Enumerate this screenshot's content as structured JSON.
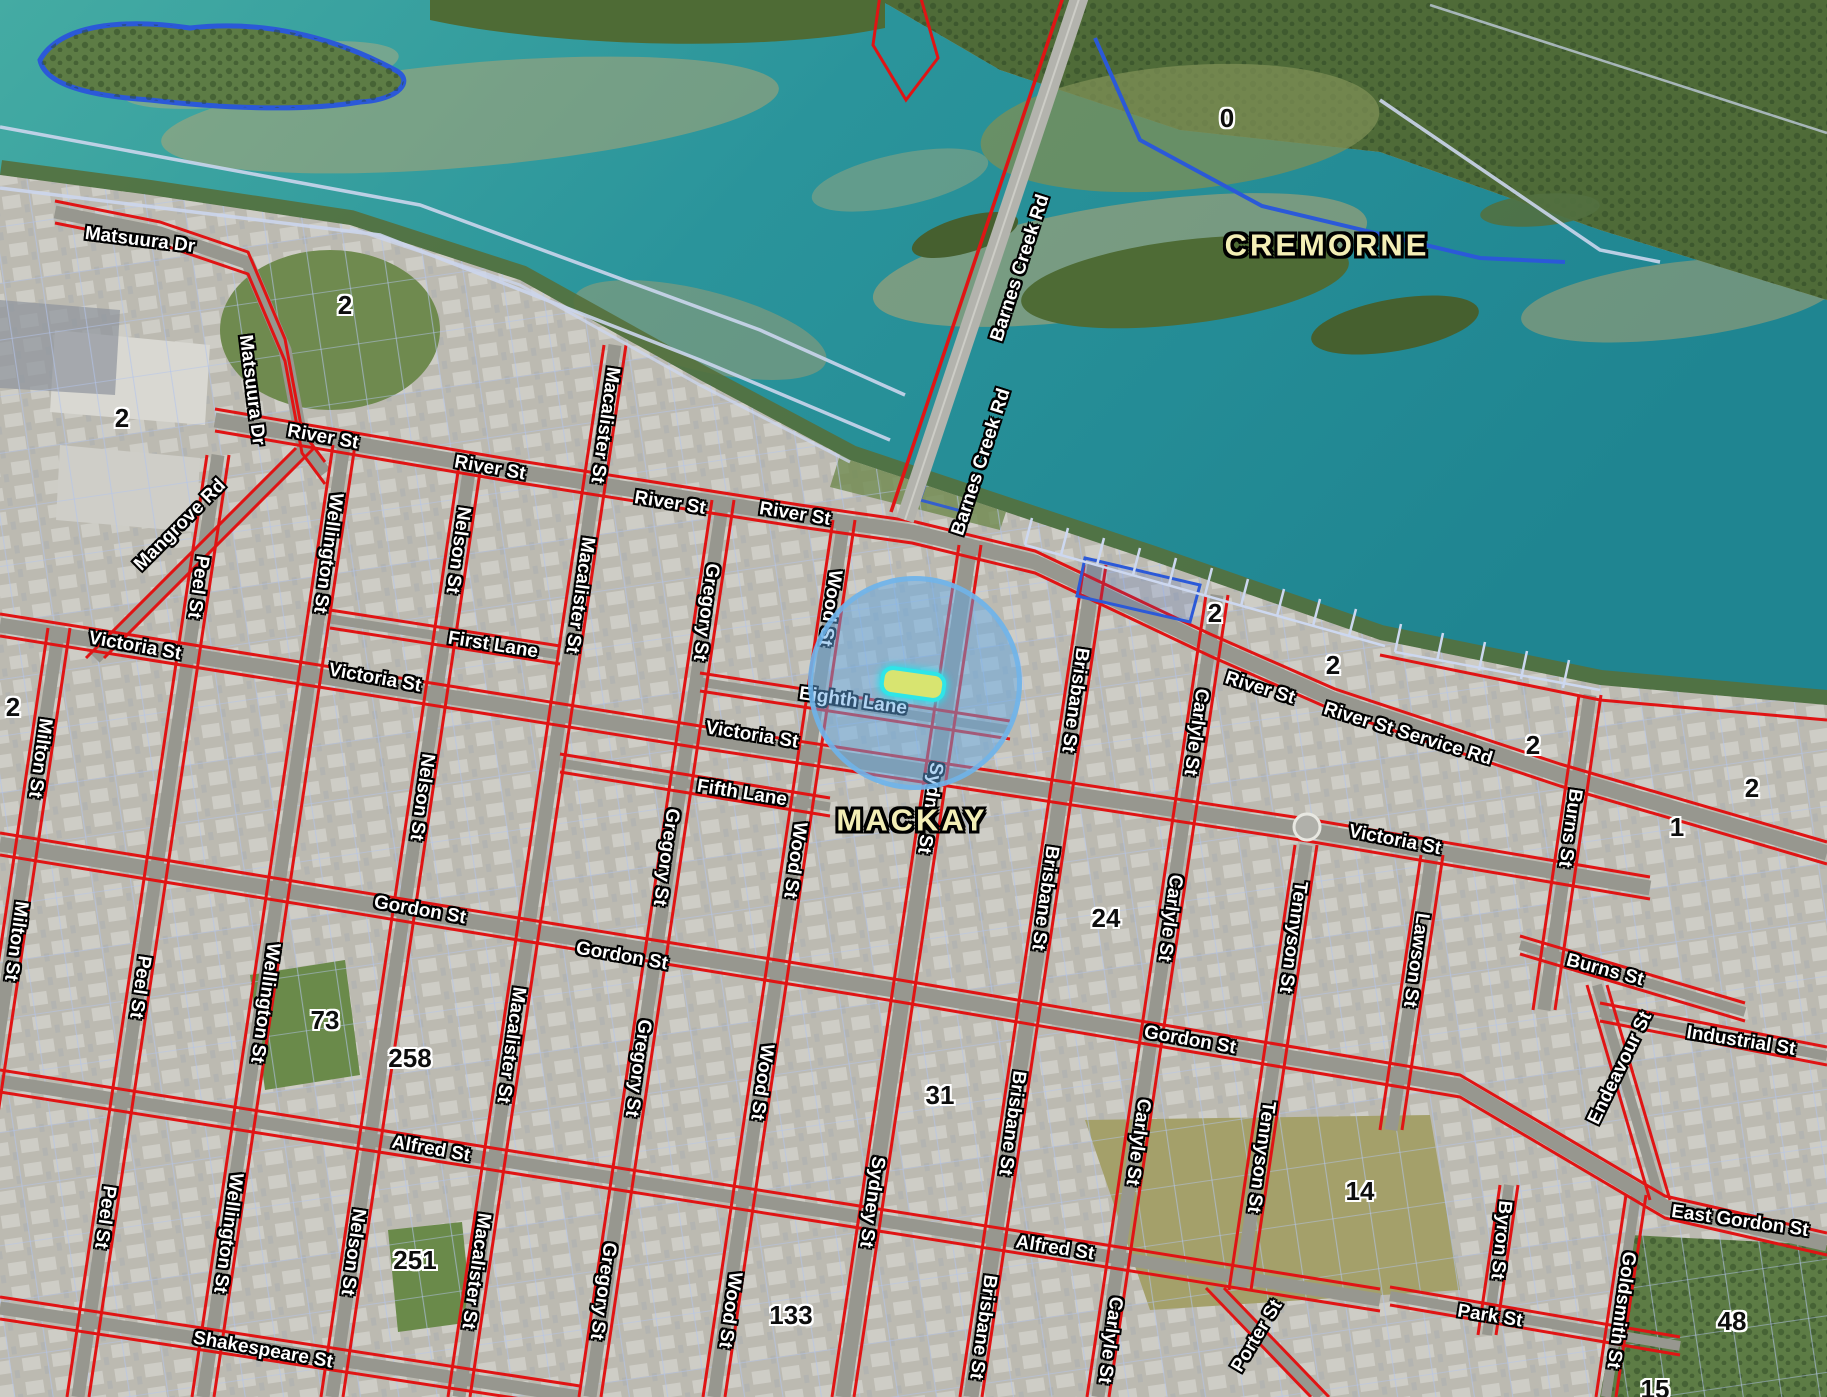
{
  "map": {
    "localities": [
      {
        "text": "MACKAY",
        "x": 912,
        "y": 820
      },
      {
        "text": "CREMORNE",
        "x": 1327,
        "y": 245
      }
    ],
    "streets": [
      {
        "text": "Matsuura Dr",
        "x": 140,
        "y": 240,
        "rot": 7
      },
      {
        "text": "Matsuura Dr",
        "x": 252,
        "y": 390,
        "rot": 83
      },
      {
        "text": "River St",
        "x": 323,
        "y": 437,
        "rot": 10
      },
      {
        "text": "River St",
        "x": 490,
        "y": 468,
        "rot": 10
      },
      {
        "text": "River St",
        "x": 670,
        "y": 503,
        "rot": 9
      },
      {
        "text": "River St",
        "x": 795,
        "y": 514,
        "rot": 9
      },
      {
        "text": "Mangrove Rd",
        "x": 180,
        "y": 525,
        "rot": -45
      },
      {
        "text": "Peel St",
        "x": 198,
        "y": 587,
        "rot": 98
      },
      {
        "text": "Wellington St",
        "x": 328,
        "y": 553,
        "rot": 98
      },
      {
        "text": "Nelson St",
        "x": 458,
        "y": 550,
        "rot": 98
      },
      {
        "text": "Macalister St",
        "x": 605,
        "y": 425,
        "rot": 98
      },
      {
        "text": "Macalister St",
        "x": 580,
        "y": 595,
        "rot": 98
      },
      {
        "text": "Gregory St",
        "x": 706,
        "y": 612,
        "rot": 98
      },
      {
        "text": "Wood St",
        "x": 830,
        "y": 608,
        "rot": 98
      },
      {
        "text": "First Lane",
        "x": 493,
        "y": 645,
        "rot": 9
      },
      {
        "text": "Victoria St",
        "x": 135,
        "y": 646,
        "rot": 10
      },
      {
        "text": "Victoria St",
        "x": 375,
        "y": 678,
        "rot": 10
      },
      {
        "text": "Victoria St",
        "x": 752,
        "y": 735,
        "rot": 9
      },
      {
        "text": "Eighth Lane",
        "x": 853,
        "y": 701,
        "rot": 8
      },
      {
        "text": "Fifth Lane",
        "x": 742,
        "y": 793,
        "rot": 9
      },
      {
        "text": "Barnes Creek Rd",
        "x": 1020,
        "y": 268,
        "rot": -72
      },
      {
        "text": "Barnes Creek Rd",
        "x": 981,
        "y": 462,
        "rot": -72
      },
      {
        "text": "Brisbane St",
        "x": 1075,
        "y": 700,
        "rot": 98
      },
      {
        "text": "Brisbane St",
        "x": 1045,
        "y": 898,
        "rot": 98
      },
      {
        "text": "Carlyle St",
        "x": 1196,
        "y": 732,
        "rot": 98
      },
      {
        "text": "Carlyle St",
        "x": 1170,
        "y": 918,
        "rot": 98
      },
      {
        "text": "River St",
        "x": 1260,
        "y": 688,
        "rot": 17
      },
      {
        "text": "River St Service Rd",
        "x": 1408,
        "y": 734,
        "rot": 17
      },
      {
        "text": "Victoria St",
        "x": 1395,
        "y": 840,
        "rot": 11
      },
      {
        "text": "Burns St",
        "x": 1570,
        "y": 828,
        "rot": 98
      },
      {
        "text": "Lawson St",
        "x": 1416,
        "y": 960,
        "rot": 98
      },
      {
        "text": "Tennyson St",
        "x": 1293,
        "y": 937,
        "rot": 98
      },
      {
        "text": "Gregory St",
        "x": 666,
        "y": 857,
        "rot": 98
      },
      {
        "text": "Wood St",
        "x": 795,
        "y": 860,
        "rot": 98
      },
      {
        "text": "Sydney St",
        "x": 930,
        "y": 808,
        "rot": 98
      },
      {
        "text": "Gordon St",
        "x": 420,
        "y": 910,
        "rot": 10
      },
      {
        "text": "Gordon St",
        "x": 622,
        "y": 956,
        "rot": 10
      },
      {
        "text": "Gordon St",
        "x": 1190,
        "y": 1040,
        "rot": 10
      },
      {
        "text": "Milton St",
        "x": 40,
        "y": 758,
        "rot": 98
      },
      {
        "text": "Milton St",
        "x": 16,
        "y": 941,
        "rot": 98
      },
      {
        "text": "Peel St",
        "x": 140,
        "y": 987,
        "rot": 98
      },
      {
        "text": "Wellington St",
        "x": 265,
        "y": 1003,
        "rot": 98
      },
      {
        "text": "Nelson St",
        "x": 422,
        "y": 797,
        "rot": 98
      },
      {
        "text": "Macalister St",
        "x": 511,
        "y": 1045,
        "rot": 98
      },
      {
        "text": "Gregory St",
        "x": 638,
        "y": 1068,
        "rot": 98
      },
      {
        "text": "Wood St",
        "x": 762,
        "y": 1082,
        "rot": 98
      },
      {
        "text": "Alfred St",
        "x": 431,
        "y": 1149,
        "rot": 10
      },
      {
        "text": "Alfred St",
        "x": 1055,
        "y": 1248,
        "rot": 9
      },
      {
        "text": "Peel St",
        "x": 105,
        "y": 1217,
        "rot": 98
      },
      {
        "text": "Wellington St",
        "x": 228,
        "y": 1233,
        "rot": 98
      },
      {
        "text": "Nelson St",
        "x": 353,
        "y": 1252,
        "rot": 98
      },
      {
        "text": "Macalister St",
        "x": 476,
        "y": 1271,
        "rot": 98
      },
      {
        "text": "Shakespeare St",
        "x": 263,
        "y": 1350,
        "rot": 10
      },
      {
        "text": "Gregory St",
        "x": 603,
        "y": 1291,
        "rot": 98
      },
      {
        "text": "Wood St",
        "x": 730,
        "y": 1310,
        "rot": 98
      },
      {
        "text": "Sydney St",
        "x": 872,
        "y": 1202,
        "rot": 98
      },
      {
        "text": "Brisbane St",
        "x": 1012,
        "y": 1123,
        "rot": 98
      },
      {
        "text": "Brisbane St",
        "x": 983,
        "y": 1327,
        "rot": 98
      },
      {
        "text": "Carlyle St",
        "x": 1138,
        "y": 1142,
        "rot": 98
      },
      {
        "text": "Carlyle St",
        "x": 1110,
        "y": 1340,
        "rot": 98
      },
      {
        "text": "Tennyson St",
        "x": 1261,
        "y": 1157,
        "rot": 98
      },
      {
        "text": "Porter St",
        "x": 1257,
        "y": 1336,
        "rot": -59
      },
      {
        "text": "Burns St",
        "x": 1605,
        "y": 970,
        "rot": 15
      },
      {
        "text": "Endeavour St",
        "x": 1620,
        "y": 1068,
        "rot": -64
      },
      {
        "text": "Industrial St",
        "x": 1741,
        "y": 1041,
        "rot": 9
      },
      {
        "text": "East Gordon St",
        "x": 1740,
        "y": 1221,
        "rot": 8
      },
      {
        "text": "Byron St",
        "x": 1501,
        "y": 1240,
        "rot": 96
      },
      {
        "text": "Goldsmith St",
        "x": 1621,
        "y": 1310,
        "rot": 98
      },
      {
        "text": "Park St",
        "x": 1490,
        "y": 1316,
        "rot": 9
      }
    ],
    "lot_numbers": [
      {
        "text": "0",
        "x": 1227,
        "y": 118
      },
      {
        "text": "2",
        "x": 345,
        "y": 305
      },
      {
        "text": "2",
        "x": 122,
        "y": 418
      },
      {
        "text": "2",
        "x": 13,
        "y": 707
      },
      {
        "text": "2",
        "x": 1215,
        "y": 613
      },
      {
        "text": "2",
        "x": 1333,
        "y": 665
      },
      {
        "text": "2",
        "x": 1533,
        "y": 745
      },
      {
        "text": "2",
        "x": 1752,
        "y": 788
      },
      {
        "text": "1",
        "x": 1677,
        "y": 827
      },
      {
        "text": "24",
        "x": 1106,
        "y": 918
      },
      {
        "text": "31",
        "x": 940,
        "y": 1095
      },
      {
        "text": "73",
        "x": 325,
        "y": 1020
      },
      {
        "text": "258",
        "x": 410,
        "y": 1058
      },
      {
        "text": "251",
        "x": 415,
        "y": 1260
      },
      {
        "text": "133",
        "x": 791,
        "y": 1315
      },
      {
        "text": "14",
        "x": 1360,
        "y": 1191
      },
      {
        "text": "48",
        "x": 1732,
        "y": 1321
      },
      {
        "text": "15",
        "x": 1655,
        "y": 1389
      }
    ],
    "highlight": {
      "shape": "circle",
      "center_x": 915,
      "center_y": 683,
      "radius": 102,
      "selected_parcel": {
        "x": 913,
        "y": 684,
        "width": 58,
        "height": 22
      }
    },
    "colors": {
      "water": "#1f8591",
      "cadastral_red": "#e01414",
      "parcel_blue": "#b3c4ec",
      "boundary_blue": "#2b59d8",
      "locality_text": "#f3eeb5",
      "street_text": "#ffffff",
      "lot_text": "#0d0d0d",
      "highlight_fill": "rgba(96,168,230,0.48)",
      "highlight_ring": "rgba(110,180,235,0.85)",
      "selected_parcel_fill": "#d8e470",
      "selected_parcel_stroke": "#2fe5e8"
    }
  }
}
